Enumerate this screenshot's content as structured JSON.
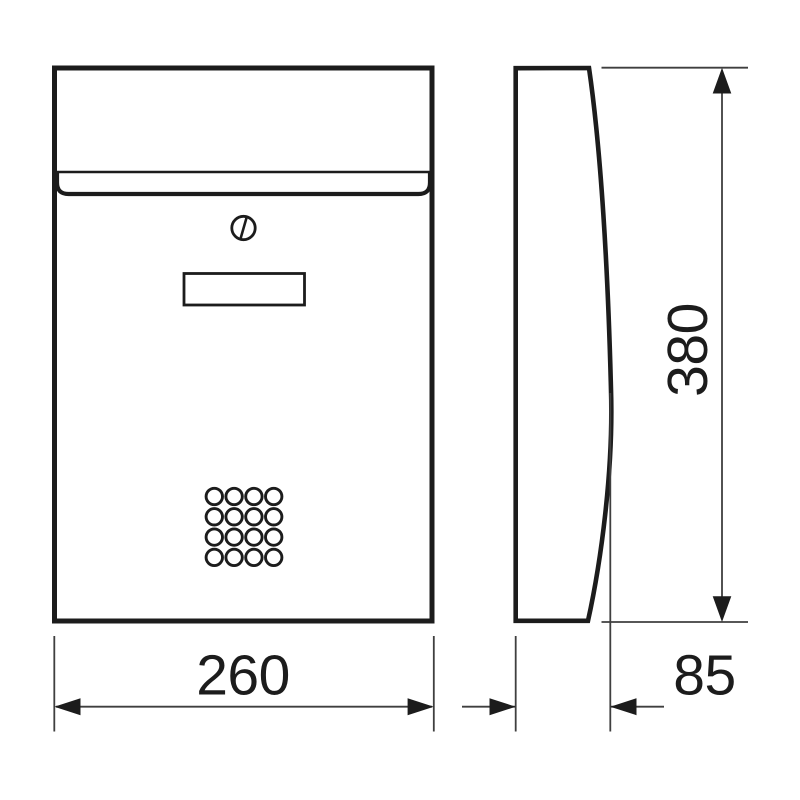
{
  "drawing": {
    "kind": "orthographic technical drawing",
    "subject": "wall-mounted letterbox with curved front, two views",
    "views": [
      {
        "id": "front-view",
        "label": "front view",
        "features": [
          "letter-slot-flap",
          "cylinder-lock",
          "name-plate",
          "ventilation-holes"
        ]
      },
      {
        "id": "side-view",
        "label": "side profile view",
        "features": [
          "curved-front-face"
        ]
      }
    ],
    "dimensions": {
      "width": {
        "value": 260,
        "label": "260",
        "axis": "horizontal",
        "applies_to": "front view width"
      },
      "height": {
        "value": 380,
        "label": "380",
        "axis": "vertical",
        "applies_to": "overall height"
      },
      "depth": {
        "value": 85,
        "label": "85",
        "axis": "horizontal",
        "applies_to": "side view depth"
      }
    },
    "ventilation_grid": {
      "rows": 4,
      "cols": 4,
      "start_x": 214.3,
      "start_y": 496.5,
      "spacing_x": 19.8,
      "spacing_y": 20.3,
      "radius": 8.2
    },
    "colors": {
      "outline": "#1c1c1c",
      "dimension_lines": "#3f3f3f",
      "background": "#ffffff"
    }
  }
}
